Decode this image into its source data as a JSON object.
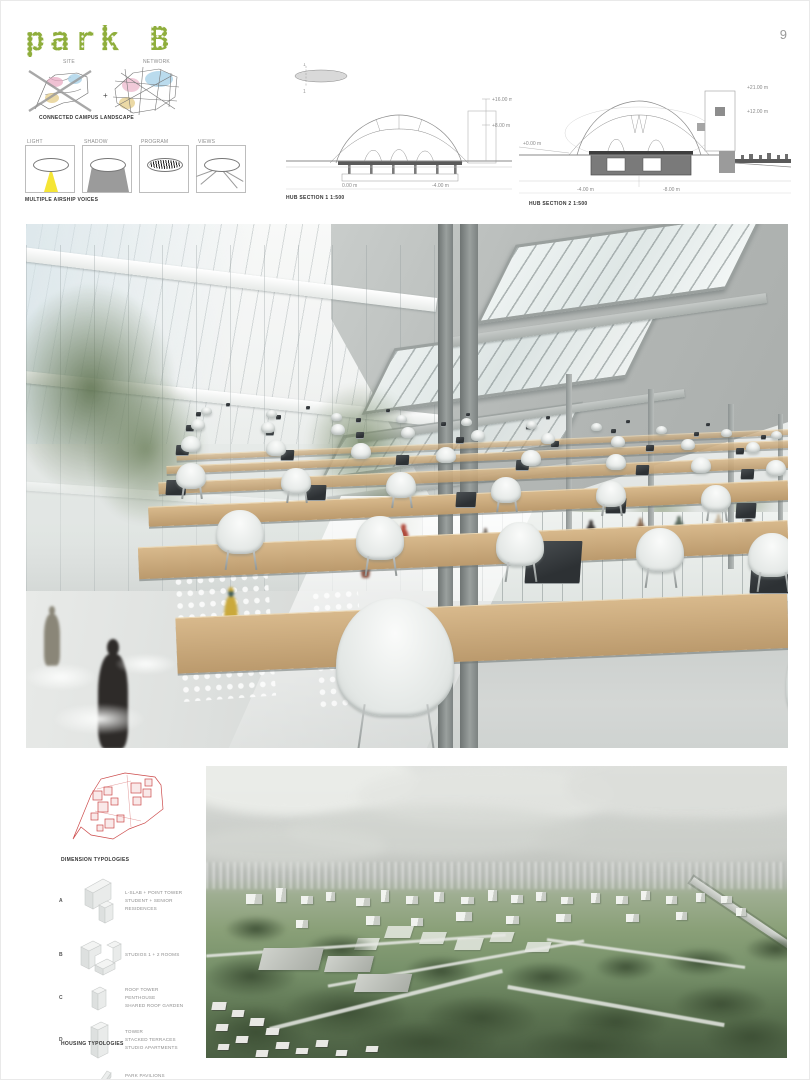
{
  "page": {
    "number": "9"
  },
  "header": {
    "title": "park B",
    "title_color": "#8fae3c"
  },
  "site_maps": {
    "label_left": "SITE",
    "label_right": "NETWORK",
    "plus": "+",
    "caption": "CONNECTED CAMPUS LANDSCAPE"
  },
  "concept_row": {
    "caption": "MULTIPLE AIRSHIP VOICES",
    "boxes": [
      {
        "label": "LIGHT"
      },
      {
        "label": "SHADOW"
      },
      {
        "label": "PROGRAM"
      },
      {
        "label": "VIEWS"
      }
    ]
  },
  "sections": {
    "one": {
      "caption": "HUB SECTION 1   1:500",
      "key_top": "1",
      "key_bottom": "1",
      "dim_right_top": "+16.00 m",
      "dim_right_mid": "+8.00 m",
      "dim_bottom_left": "0.00 m",
      "dim_bottom_right": "-4.00 m"
    },
    "two": {
      "caption": "HUB SECTION 2   1:500",
      "dim_right_top": "+21.00 m",
      "dim_right_mid": "+12.00 m",
      "dim_left": "+0.00 m",
      "dim_bottom_left": "-4.00 m",
      "dim_bottom_mid": "-8.00 m"
    }
  },
  "typologies": {
    "plan_caption": "DIMENSION TYPOLOGIES",
    "footer_caption": "HOUSING TYPOLOGIES",
    "items": [
      {
        "key": "A",
        "lines": [
          "L-SLAB + POINT TOWER",
          "STUDENT + SENIOR",
          "RESIDENCES"
        ]
      },
      {
        "key": "B",
        "lines": [
          "STUDIOS  1 + 2 ROOMS"
        ]
      },
      {
        "key": "C",
        "lines": [
          "ROOF TOWER",
          "PENTHOUSE",
          "SHARED ROOF GARDEN"
        ]
      },
      {
        "key": "D",
        "lines": [
          "TOWER",
          "STACKED TERRACES",
          "STUDIO APARTMENTS"
        ]
      },
      {
        "key": "E",
        "lines": [
          "PARK PAVILIONS",
          "SCATTERED UNITS",
          "IN THE GREEN"
        ]
      }
    ]
  },
  "colors": {
    "accent_green": "#8fae3c",
    "plan_red": "#cc4a4a",
    "wood": "#c3a173"
  }
}
